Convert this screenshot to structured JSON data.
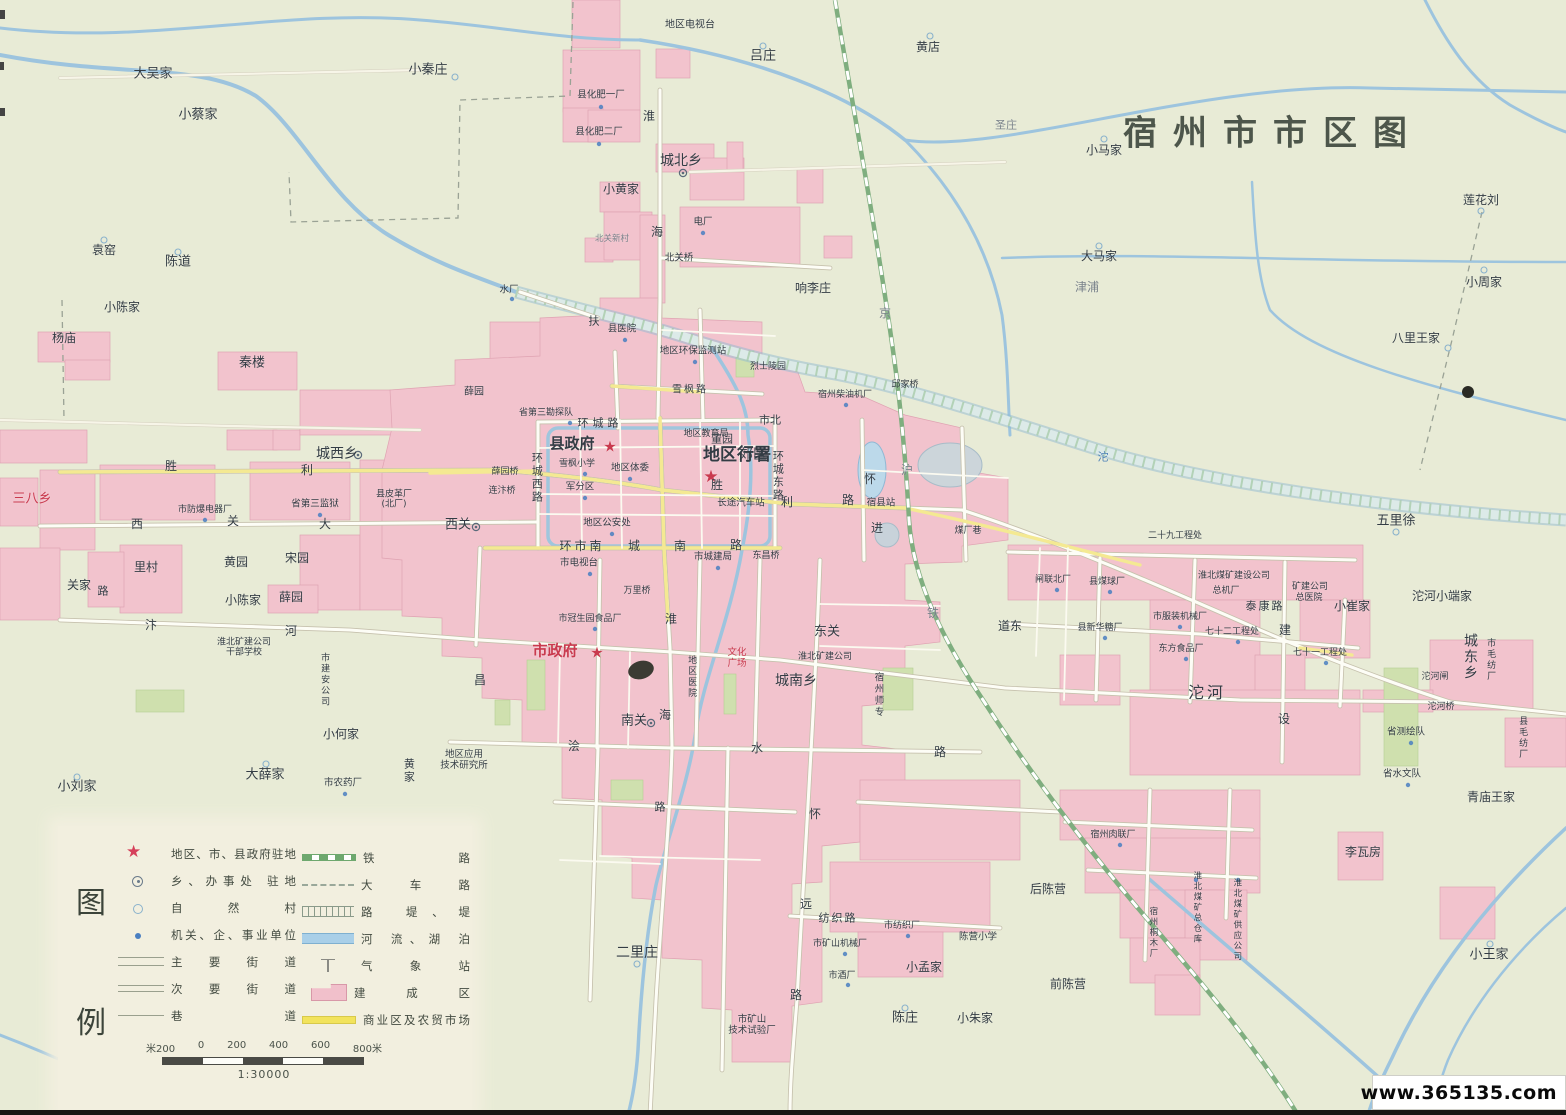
{
  "title": "宿州市市区图",
  "watermark": "www.365135.com",
  "colors": {
    "background": "#e8ebd6",
    "built_up": "#f2c3cd",
    "main_road_yellow": "#f4e992",
    "river_blue": "#9dc4de",
    "railway_green": "#6ea86e",
    "gov_star_red": "#d6405a",
    "title_gray": "#4d564b"
  },
  "legend": {
    "head1": "图",
    "head2": "例",
    "left_items": [
      {
        "sym": "star",
        "label": "地区、市、县政府驻地"
      },
      {
        "sym": "seat",
        "label": "乡、办事处 驻地"
      },
      {
        "sym": "ring",
        "label": "自 然 村"
      },
      {
        "sym": "dot",
        "label": "机关、企、事业单位"
      },
      {
        "sym": "road-major",
        "label": "主 要 街 道"
      },
      {
        "sym": "road-minor",
        "label": "次 要 街 道"
      },
      {
        "sym": "road-lane",
        "label": "巷 道"
      }
    ],
    "right_items": [
      {
        "sym": "rail",
        "label": "铁 路"
      },
      {
        "sym": "cart",
        "label": "大 车 路"
      },
      {
        "sym": "emb",
        "label": "路 堤、堤"
      },
      {
        "sym": "river",
        "label": "河 流、湖 泊"
      },
      {
        "sym": "weather",
        "label": "气 象 站"
      },
      {
        "sym": "built",
        "label": "建 成 区"
      },
      {
        "sym": "market",
        "label": "商业区及农贸市场"
      }
    ],
    "scale_ticks": [
      "米200",
      "0",
      "200",
      "400",
      "600",
      "800米"
    ],
    "scale_ratio": "1:30000"
  },
  "map": {
    "labels": [
      {
        "t": "大吴家",
        "x": 153,
        "y": 75,
        "s": 13
      },
      {
        "t": "小蔡家",
        "x": 198,
        "y": 116,
        "s": 13
      },
      {
        "t": "小秦庄",
        "x": 428,
        "y": 71,
        "s": 13
      },
      {
        "t": "袁窑",
        "x": 104,
        "y": 251,
        "s": 12
      },
      {
        "t": "陈道",
        "x": 178,
        "y": 263,
        "s": 13
      },
      {
        "t": "小陈家",
        "x": 122,
        "y": 308,
        "s": 12
      },
      {
        "t": "杨庙",
        "x": 64,
        "y": 339,
        "s": 12
      },
      {
        "t": "秦楼",
        "x": 252,
        "y": 364,
        "s": 13
      },
      {
        "t": "地区电视台",
        "x": 690,
        "y": 25,
        "s": 10
      },
      {
        "t": "吕庄",
        "x": 763,
        "y": 57,
        "s": 13
      },
      {
        "t": "黄店",
        "x": 928,
        "y": 48,
        "s": 12
      },
      {
        "t": "县化肥一厂",
        "x": 601,
        "y": 96,
        "s": 9.5
      },
      {
        "t": "县化肥二厂",
        "x": 599,
        "y": 133,
        "s": 9.5
      },
      {
        "t": "圣庄",
        "x": 1006,
        "y": 126,
        "s": 11,
        "c": "gray"
      },
      {
        "t": "小马家",
        "x": 1104,
        "y": 151,
        "s": 12
      },
      {
        "t": "城北乡",
        "x": 681,
        "y": 161,
        "s": 14
      },
      {
        "t": "小黄家",
        "x": 621,
        "y": 190,
        "s": 12
      },
      {
        "t": "大马家",
        "x": 1099,
        "y": 257,
        "s": 12
      },
      {
        "t": "津浦",
        "x": 1087,
        "y": 288,
        "s": 12,
        "c": "gray"
      },
      {
        "t": "莲花刘",
        "x": 1481,
        "y": 201,
        "s": 12
      },
      {
        "t": "小周家",
        "x": 1484,
        "y": 283,
        "s": 12
      },
      {
        "t": "响李庄",
        "x": 813,
        "y": 289,
        "s": 12
      },
      {
        "t": "八里王家",
        "x": 1416,
        "y": 339,
        "s": 12
      },
      {
        "t": "电厂",
        "x": 703,
        "y": 223,
        "s": 9.5
      },
      {
        "t": "北关桥",
        "x": 679,
        "y": 259,
        "s": 9.5
      },
      {
        "t": "水厂",
        "x": 509,
        "y": 291,
        "s": 9.5
      },
      {
        "t": "北关新村",
        "x": 612,
        "y": 240,
        "s": 8.5,
        "c": "gray"
      },
      {
        "t": "县医院",
        "x": 622,
        "y": 330,
        "s": 9.5
      },
      {
        "t": "地区环保监测站",
        "x": 693,
        "y": 352,
        "s": 9.5
      },
      {
        "t": "烈士陵园",
        "x": 768,
        "y": 367,
        "s": 9
      },
      {
        "t": "扶",
        "x": 594,
        "y": 322,
        "s": 11
      },
      {
        "t": "京",
        "x": 885,
        "y": 314,
        "s": 12,
        "c": "gray"
      },
      {
        "t": "沪",
        "x": 907,
        "y": 471,
        "s": 12,
        "c": "gray"
      },
      {
        "t": "宿州柴油机厂",
        "x": 845,
        "y": 395,
        "s": 9
      },
      {
        "t": "邱家桥",
        "x": 905,
        "y": 385,
        "s": 9
      },
      {
        "t": "郊区",
        "x": 753,
        "y": 455,
        "s": 14
      },
      {
        "t": "董园",
        "x": 722,
        "y": 440,
        "s": 11
      },
      {
        "t": "城西乡",
        "x": 337,
        "y": 454,
        "s": 14
      },
      {
        "t": "三八乡",
        "x": 32,
        "y": 500,
        "s": 13,
        "c": "red"
      },
      {
        "t": "胜",
        "x": 171,
        "y": 467,
        "s": 12
      },
      {
        "t": "利",
        "x": 307,
        "y": 471,
        "s": 12
      },
      {
        "t": "省第三勘探队",
        "x": 546,
        "y": 413,
        "s": 9
      },
      {
        "t": "薛园",
        "x": 474,
        "y": 392,
        "s": 10
      },
      {
        "t": "县政府",
        "x": 572,
        "y": 444,
        "s": 15,
        "b": 1
      },
      {
        "t": "★",
        "x": 610,
        "y": 447,
        "s": 15,
        "c": "red"
      },
      {
        "t": "雪枫小学",
        "x": 577,
        "y": 464,
        "s": 9
      },
      {
        "t": "地区教育局",
        "x": 706,
        "y": 434,
        "s": 9
      },
      {
        "t": "地区行署",
        "x": 737,
        "y": 456,
        "s": 17,
        "b": 1
      },
      {
        "t": "★",
        "x": 711,
        "y": 478,
        "s": 17,
        "c": "red"
      },
      {
        "t": "市北",
        "x": 770,
        "y": 421,
        "s": 11
      },
      {
        "t": "环城路",
        "x": 600,
        "y": 424,
        "s": 11,
        "ls": 4
      },
      {
        "t": "地区体委",
        "x": 630,
        "y": 469,
        "s": 9.5
      },
      {
        "t": "军分区",
        "x": 580,
        "y": 488,
        "s": 9.5
      },
      {
        "t": "薛园桥",
        "x": 505,
        "y": 472,
        "s": 9
      },
      {
        "t": "连汴桥",
        "x": 502,
        "y": 491,
        "s": 9
      },
      {
        "t": "长途汽车站",
        "x": 741,
        "y": 504,
        "s": 9.5
      },
      {
        "t": "胜",
        "x": 717,
        "y": 486,
        "s": 12
      },
      {
        "t": "利",
        "x": 787,
        "y": 503,
        "s": 12
      },
      {
        "t": "路",
        "x": 848,
        "y": 501,
        "s": 12
      },
      {
        "t": "宿县站",
        "x": 881,
        "y": 504,
        "s": 9.5
      },
      {
        "t": "怀",
        "x": 870,
        "y": 480,
        "s": 12
      },
      {
        "t": "进",
        "x": 877,
        "y": 529,
        "s": 12
      },
      {
        "t": "环城西路",
        "x": 536,
        "y": 478,
        "s": 11,
        "v": 1
      },
      {
        "t": "环城东路",
        "x": 777,
        "y": 476,
        "s": 11,
        "v": 1
      },
      {
        "t": "地区公安处",
        "x": 607,
        "y": 524,
        "s": 9.5
      },
      {
        "t": "西关",
        "x": 458,
        "y": 526,
        "s": 13
      },
      {
        "t": "西",
        "x": 137,
        "y": 525,
        "s": 12
      },
      {
        "t": "关",
        "x": 233,
        "y": 522,
        "s": 12
      },
      {
        "t": "大",
        "x": 325,
        "y": 525,
        "s": 12
      },
      {
        "t": "县皮革厂\n(北厂)",
        "x": 394,
        "y": 500,
        "s": 9
      },
      {
        "t": "省第三监狱",
        "x": 315,
        "y": 505,
        "s": 9.5
      },
      {
        "t": "市防爆电器厂",
        "x": 205,
        "y": 510,
        "s": 9
      },
      {
        "t": "黄园",
        "x": 236,
        "y": 563,
        "s": 12
      },
      {
        "t": "宋园",
        "x": 297,
        "y": 559,
        "s": 12
      },
      {
        "t": "里村",
        "x": 146,
        "y": 568,
        "s": 12
      },
      {
        "t": "关家",
        "x": 79,
        "y": 586,
        "s": 12
      },
      {
        "t": "路",
        "x": 103,
        "y": 592,
        "s": 11
      },
      {
        "t": "小陈家",
        "x": 243,
        "y": 601,
        "s": 12
      },
      {
        "t": "薛园",
        "x": 291,
        "y": 598,
        "s": 12
      },
      {
        "t": "环市南",
        "x": 582,
        "y": 547,
        "s": 12,
        "ls": 3
      },
      {
        "t": "城",
        "x": 634,
        "y": 547,
        "s": 12
      },
      {
        "t": "南",
        "x": 680,
        "y": 547,
        "s": 12
      },
      {
        "t": "路",
        "x": 736,
        "y": 546,
        "s": 12
      },
      {
        "t": "市电视台",
        "x": 579,
        "y": 564,
        "s": 9.5
      },
      {
        "t": "市城建局",
        "x": 713,
        "y": 558,
        "s": 9.5
      },
      {
        "t": "东昌桥",
        "x": 766,
        "y": 556,
        "s": 9
      },
      {
        "t": "万里桥",
        "x": 637,
        "y": 591,
        "s": 9
      },
      {
        "t": "汴",
        "x": 151,
        "y": 626,
        "s": 12
      },
      {
        "t": "河",
        "x": 291,
        "y": 632,
        "s": 12
      },
      {
        "t": "淮北矿建公司\n干部学校",
        "x": 244,
        "y": 648,
        "s": 9
      },
      {
        "t": "市建安公司",
        "x": 324,
        "y": 680,
        "s": 9,
        "v": 1
      },
      {
        "t": "淮",
        "x": 649,
        "y": 117,
        "s": 12
      },
      {
        "t": "海",
        "x": 657,
        "y": 233,
        "s": 12
      },
      {
        "t": "淮",
        "x": 671,
        "y": 620,
        "s": 12
      },
      {
        "t": "海",
        "x": 665,
        "y": 716,
        "s": 12
      },
      {
        "t": "市冠生园食品厂",
        "x": 590,
        "y": 619,
        "s": 9
      },
      {
        "t": "市政府",
        "x": 555,
        "y": 651,
        "s": 15,
        "c": "red",
        "b": 1
      },
      {
        "t": "★",
        "x": 597,
        "y": 653,
        "s": 15,
        "c": "red"
      },
      {
        "t": "昌",
        "x": 480,
        "y": 681,
        "s": 12
      },
      {
        "t": "地区医院",
        "x": 691,
        "y": 677,
        "s": 9,
        "v": 1
      },
      {
        "t": "文化\n广场",
        "x": 737,
        "y": 659,
        "s": 9.5,
        "c": "red"
      },
      {
        "t": "城南乡",
        "x": 796,
        "y": 681,
        "s": 14
      },
      {
        "t": "东关",
        "x": 827,
        "y": 633,
        "s": 13
      },
      {
        "t": "淮北矿建公司",
        "x": 825,
        "y": 657,
        "s": 9
      },
      {
        "t": "宿州师专",
        "x": 877,
        "y": 695,
        "s": 9.5,
        "v": 1
      },
      {
        "t": "道东",
        "x": 1010,
        "y": 627,
        "s": 12
      },
      {
        "t": "沱",
        "x": 1103,
        "y": 458,
        "s": 11,
        "c": "blue"
      },
      {
        "t": "五里徐",
        "x": 1396,
        "y": 522,
        "s": 13
      },
      {
        "t": "二十九工程处",
        "x": 1175,
        "y": 536,
        "s": 9
      },
      {
        "t": "淮北煤矿建设公司",
        "x": 1234,
        "y": 576,
        "s": 9
      },
      {
        "t": "总机厂",
        "x": 1226,
        "y": 591,
        "s": 9
      },
      {
        "t": "矿建公司",
        "x": 1310,
        "y": 587,
        "s": 9
      },
      {
        "t": "总医院",
        "x": 1309,
        "y": 598,
        "s": 9
      },
      {
        "t": "小崔家",
        "x": 1352,
        "y": 607,
        "s": 12
      },
      {
        "t": "沱河小端家",
        "x": 1442,
        "y": 597,
        "s": 12
      },
      {
        "t": "县煤球厂",
        "x": 1107,
        "y": 582,
        "s": 9
      },
      {
        "t": "闸联北厂",
        "x": 1053,
        "y": 580,
        "s": 9
      },
      {
        "t": "泰康路",
        "x": 1265,
        "y": 607,
        "s": 11,
        "ls": 2
      },
      {
        "t": "市服装机械厂",
        "x": 1180,
        "y": 617,
        "s": 9
      },
      {
        "t": "县新华糖厂",
        "x": 1100,
        "y": 628,
        "s": 9
      },
      {
        "t": "七十二工程处",
        "x": 1232,
        "y": 632,
        "s": 9
      },
      {
        "t": "建",
        "x": 1285,
        "y": 631,
        "s": 12
      },
      {
        "t": "设",
        "x": 1284,
        "y": 720,
        "s": 12
      },
      {
        "t": "东方食品厂",
        "x": 1181,
        "y": 649,
        "s": 9
      },
      {
        "t": "七十一工程处",
        "x": 1320,
        "y": 653,
        "s": 9
      },
      {
        "t": "城东乡",
        "x": 1470,
        "y": 657,
        "s": 14,
        "v": 1
      },
      {
        "t": "市毛纺厂",
        "x": 1490,
        "y": 660,
        "s": 9,
        "v": 1
      },
      {
        "t": "沱河闸",
        "x": 1435,
        "y": 677,
        "s": 9
      },
      {
        "t": "沱河桥",
        "x": 1441,
        "y": 707,
        "s": 9
      },
      {
        "t": "县毛纺厂",
        "x": 1522,
        "y": 738,
        "s": 9,
        "v": 1
      },
      {
        "t": "省测绘队",
        "x": 1406,
        "y": 733,
        "s": 9.5
      },
      {
        "t": "省水文队",
        "x": 1402,
        "y": 775,
        "s": 9.5
      },
      {
        "t": "青庙王家",
        "x": 1491,
        "y": 798,
        "s": 12
      },
      {
        "t": "沱河",
        "x": 1207,
        "y": 693,
        "s": 16,
        "ls": 3
      },
      {
        "t": "煤厂巷",
        "x": 968,
        "y": 531,
        "s": 9
      },
      {
        "t": "铁",
        "x": 933,
        "y": 614,
        "s": 12,
        "c": "gray"
      },
      {
        "t": "浍",
        "x": 574,
        "y": 747,
        "s": 12
      },
      {
        "t": "水",
        "x": 757,
        "y": 749,
        "s": 12
      },
      {
        "t": "路",
        "x": 940,
        "y": 753,
        "s": 12
      },
      {
        "t": "南关",
        "x": 634,
        "y": 722,
        "s": 13
      },
      {
        "t": "地区应用\n技术研究所",
        "x": 464,
        "y": 761,
        "s": 9.5
      },
      {
        "t": "市农药厂",
        "x": 343,
        "y": 784,
        "s": 9.5
      },
      {
        "t": "黄家",
        "x": 408,
        "y": 771,
        "s": 11,
        "v": 1
      },
      {
        "t": "小何家",
        "x": 341,
        "y": 735,
        "s": 12
      },
      {
        "t": "大薛家",
        "x": 265,
        "y": 776,
        "s": 13
      },
      {
        "t": "小刘家",
        "x": 77,
        "y": 788,
        "s": 13
      },
      {
        "t": "怀",
        "x": 815,
        "y": 815,
        "s": 12
      },
      {
        "t": "远",
        "x": 806,
        "y": 905,
        "s": 12
      },
      {
        "t": "路",
        "x": 796,
        "y": 996,
        "s": 12
      },
      {
        "t": "路",
        "x": 660,
        "y": 808,
        "s": 11
      },
      {
        "t": "二里庄",
        "x": 637,
        "y": 953,
        "s": 14
      },
      {
        "t": "纺织路",
        "x": 838,
        "y": 919,
        "s": 11,
        "ls": 2
      },
      {
        "t": "市纺织厂",
        "x": 902,
        "y": 926,
        "s": 9
      },
      {
        "t": "市矿山机械厂",
        "x": 840,
        "y": 944,
        "s": 9
      },
      {
        "t": "市酒厂",
        "x": 842,
        "y": 976,
        "s": 9
      },
      {
        "t": "小孟家",
        "x": 924,
        "y": 968,
        "s": 12
      },
      {
        "t": "陈营小学",
        "x": 978,
        "y": 938,
        "s": 9.5
      },
      {
        "t": "市矿山\n技术试验厂",
        "x": 752,
        "y": 1026,
        "s": 9.5
      },
      {
        "t": "陈庄",
        "x": 905,
        "y": 1019,
        "s": 13
      },
      {
        "t": "小朱家",
        "x": 975,
        "y": 1019,
        "s": 12
      },
      {
        "t": "宿州肉联厂",
        "x": 1113,
        "y": 835,
        "s": 9
      },
      {
        "t": "李瓦房",
        "x": 1363,
        "y": 853,
        "s": 12
      },
      {
        "t": "后陈营",
        "x": 1048,
        "y": 890,
        "s": 12
      },
      {
        "t": "前陈营",
        "x": 1068,
        "y": 985,
        "s": 12
      },
      {
        "t": "淮北煤矿总仓库",
        "x": 1196,
        "y": 908,
        "s": 8.5,
        "v": 1
      },
      {
        "t": "淮北煤矿供应公司",
        "x": 1236,
        "y": 920,
        "s": 8.5,
        "v": 1
      },
      {
        "t": "宿州桐木厂",
        "x": 1152,
        "y": 933,
        "s": 8.5,
        "v": 1
      },
      {
        "t": "小王家",
        "x": 1489,
        "y": 956,
        "s": 13
      },
      {
        "t": "雪枫路",
        "x": 690,
        "y": 390,
        "s": 10,
        "ls": 2
      }
    ]
  }
}
